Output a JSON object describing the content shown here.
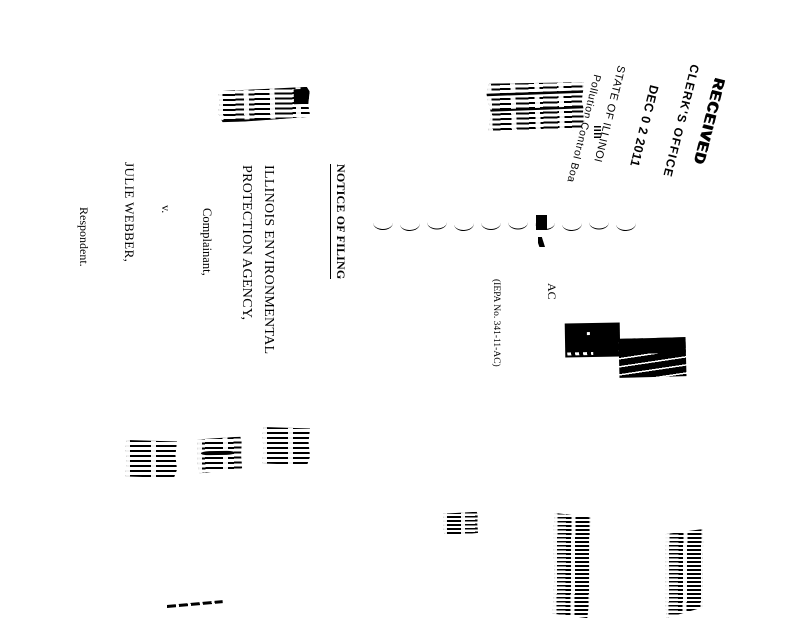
{
  "page": {
    "background": "#ffffff",
    "ink": "#000000"
  },
  "stamp": {
    "received": "RECEIVED",
    "clerks_office": "CLERK'S OFFICE",
    "date": "DEC 0 2 2011",
    "state": "STATE OF ILLINOI",
    "board": "Pollution Control Boa"
  },
  "notice": {
    "title": "NOTICE OF FILING"
  },
  "caption": {
    "complainant_name_line1": "ILLINOIS ENVIRONMENTAL",
    "complainant_name_line2": "PROTECTION AGENCY,",
    "complainant_role": "Complainant,",
    "versus": "v.",
    "respondent_name": "JULIE WEBBER,",
    "respondent_role": "Respondent.",
    "docket_prefix": "AC",
    "iepa_number": "(IEPA No. 341-11-AC)",
    "separator_mark_count": 10
  }
}
